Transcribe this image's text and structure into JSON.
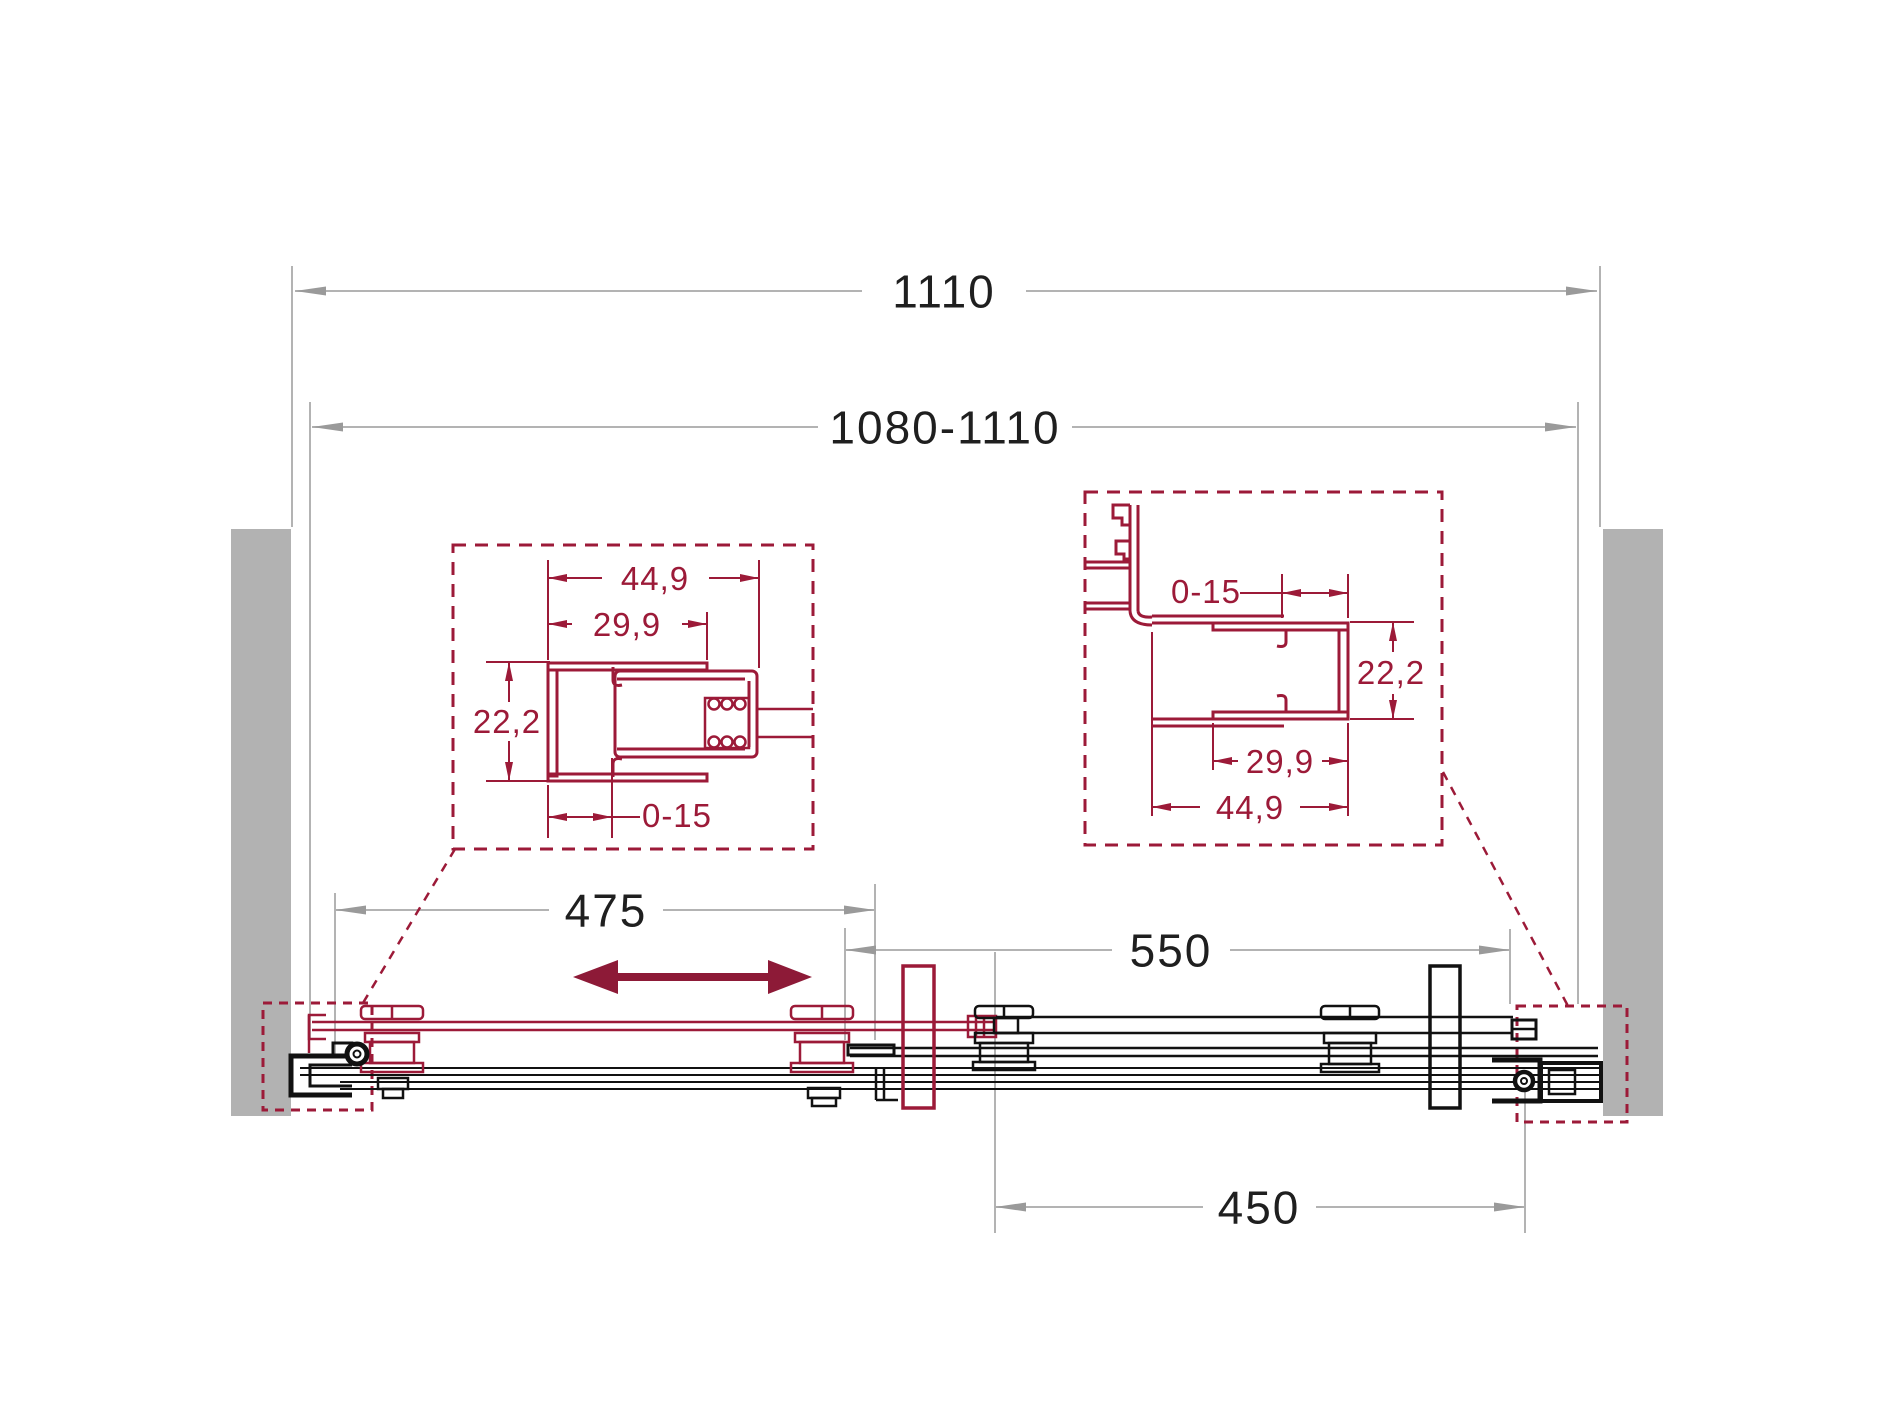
{
  "drawing_type": "shower-door-sliding-mechanism-technical-drawing",
  "colors": {
    "accent": "#9c1a38",
    "accent_dark": "#8d1a37",
    "wall_gray": "#b2b2b2",
    "dim_line_gray": "#b3b3b3",
    "dim_arrow_gray": "#9a9a9a",
    "text_dark": "#1f1f1f"
  },
  "dimensions": {
    "overall_width": "1110",
    "adjustable_width": "1080-1110",
    "door_panel_width": "475",
    "opening_width": "550",
    "fixed_panel_width": "450"
  },
  "detail_left": {
    "outer_width": "44,9",
    "inner_width": "29,9",
    "depth": "22,2",
    "adjustment": "0-15"
  },
  "detail_right": {
    "adjustment": "0-15",
    "depth": "22,2",
    "inner_width": "29,9",
    "outer_width": "44,9"
  },
  "icons": {
    "slide_direction": "double-headed-arrow"
  }
}
